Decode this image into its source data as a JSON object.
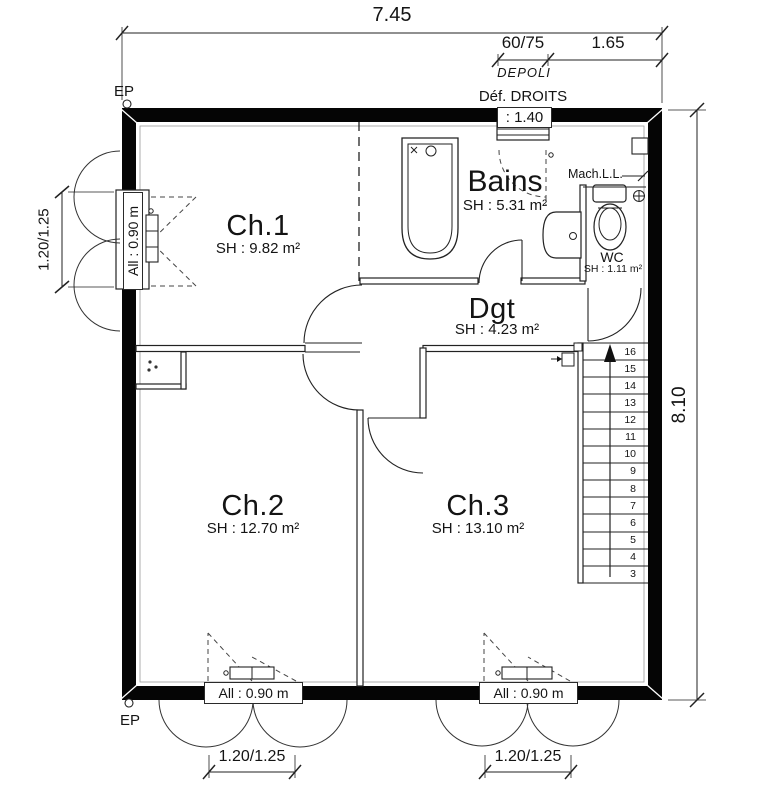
{
  "plan": {
    "dimensions": {
      "top_overall": "7.45",
      "top_window": "60/75",
      "top_right": "1.65",
      "right_overall": "8.10",
      "left_window": "1.20/1.25",
      "bottom_window_left": "1.20/1.25",
      "bottom_window_right": "1.20/1.25"
    },
    "annotations": {
      "depoli": "DEPOLI",
      "def_droits": "Déf. DROITS",
      "top_window_height": ": 1.40",
      "ep_top": "EP",
      "ep_bottom": "EP",
      "mach": "Mach.L.L.",
      "allege_left": "All : 0.90 m",
      "allege_bottom_left": "All : 0.90 m",
      "allege_bottom_right": "All : 0.90 m"
    },
    "rooms": {
      "ch1": {
        "name": "Ch.1",
        "area": "SH : 9.82 m²"
      },
      "bains": {
        "name": "Bains",
        "area": "SH : 5.31 m²"
      },
      "wc": {
        "name": "WC",
        "area": "SH : 1.11 m²"
      },
      "dgt": {
        "name": "Dgt",
        "area": "SH : 4.23 m²"
      },
      "ch2": {
        "name": "Ch.2",
        "area": "SH : 12.70 m²"
      },
      "ch3": {
        "name": "Ch.3",
        "area": "SH : 13.10 m²"
      }
    },
    "stairs": {
      "numbers": [
        16,
        15,
        14,
        13,
        12,
        11,
        10,
        9,
        8,
        7,
        6,
        5,
        4,
        3
      ]
    }
  }
}
